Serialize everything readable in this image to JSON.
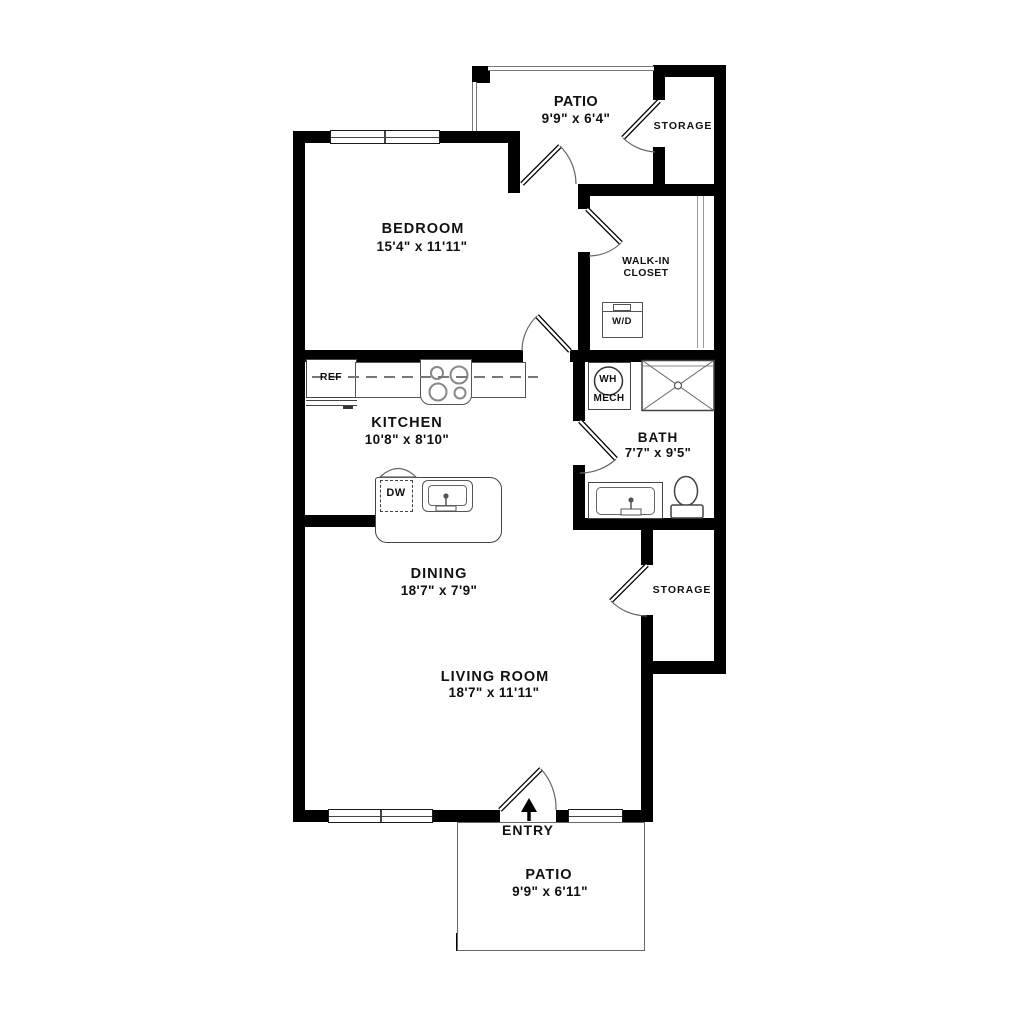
{
  "rooms": {
    "patio_top": {
      "name": "PATIO",
      "dims": "9'9\" x 6'4\""
    },
    "storage_top": {
      "name": "STORAGE"
    },
    "bedroom": {
      "name": "BEDROOM",
      "dims": "15'4\" x 11'11\""
    },
    "walk_in_closet": {
      "line1": "WALK-IN",
      "line2": "CLOSET"
    },
    "kitchen": {
      "name": "KITCHEN",
      "dims": "10'8\" x 8'10\""
    },
    "bath": {
      "name": "BATH",
      "dims": "7'7\" x 9'5\""
    },
    "dining": {
      "name": "DINING",
      "dims": "18'7\" x 7'9\""
    },
    "storage_bottom": {
      "name": "STORAGE"
    },
    "living_room": {
      "name": "LIVING ROOM",
      "dims": "18'7\" x 11'11\""
    },
    "entry": {
      "name": "ENTRY"
    },
    "patio_bottom": {
      "name": "PATIO",
      "dims": "9'9\" x 6'11\""
    }
  },
  "appliances": {
    "refrigerator": "REF",
    "dishwasher": "DW",
    "washer_dryer": "W/D",
    "water_heater": "WH",
    "mechanical": "MECH"
  },
  "colors": {
    "wall": "#000000",
    "fixture_line": "#555555",
    "background": "#ffffff"
  }
}
